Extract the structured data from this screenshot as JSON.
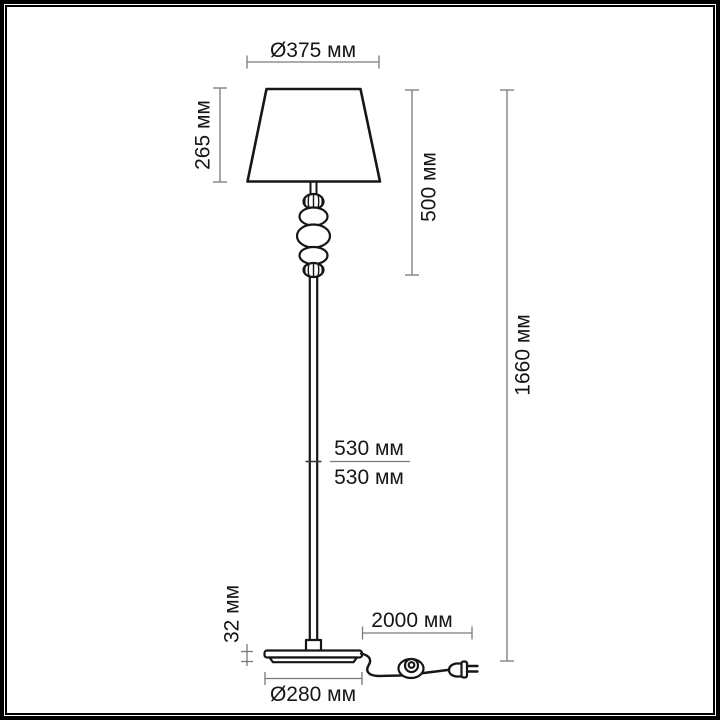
{
  "diagram": {
    "dimensions": {
      "shade_diameter": "Ø375 мм",
      "shade_height": "265 мм",
      "upper_section_height": "500 мм",
      "total_height": "1660 мм",
      "pole_upper_section": "530 мм",
      "pole_lower_section": "530 мм",
      "base_height": "32 мм",
      "cord_length": "2000 мм",
      "base_diameter": "Ø280 мм"
    },
    "colors": {
      "outline": "#161616",
      "dimension_line": "#7a7a7a",
      "label_text": "#161616",
      "background": "#ffffff",
      "frame": "#000000"
    }
  }
}
